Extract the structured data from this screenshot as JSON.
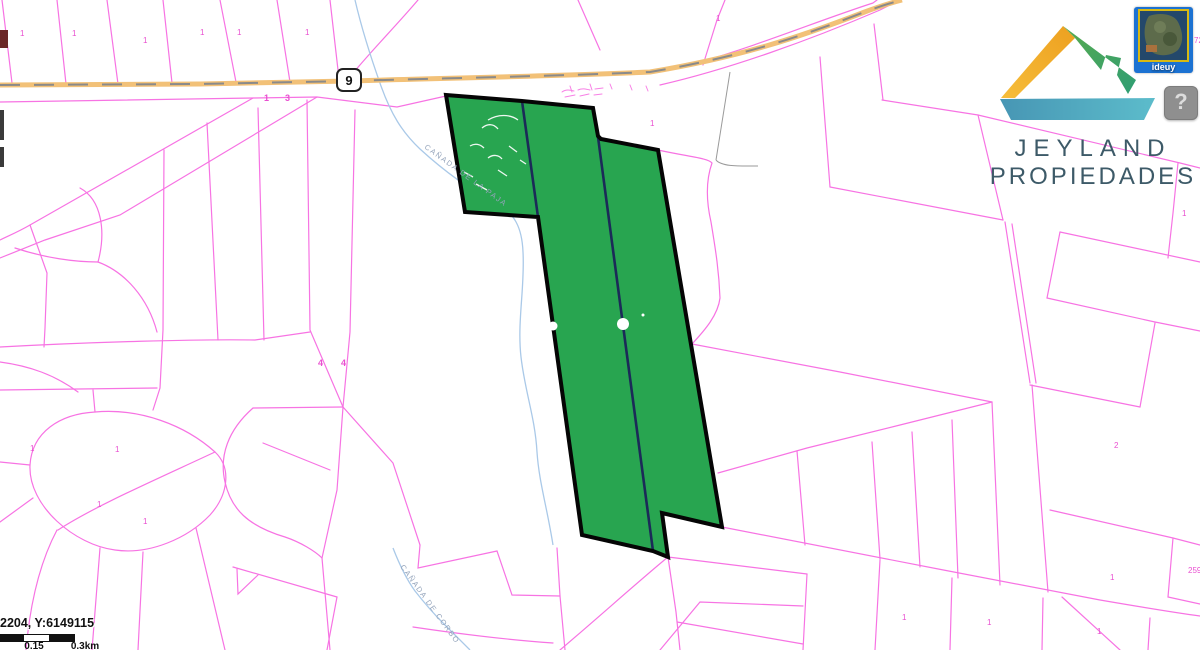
{
  "map": {
    "route_shield_label": "9",
    "stream_labels": [
      {
        "text": "CAÑADA DE LA PAJA",
        "x": 424,
        "y": 148,
        "angle": 36
      },
      {
        "text": "CAÑADA DE CORBO",
        "x": 400,
        "y": 567,
        "angle": 54
      }
    ],
    "parcel_labels": [
      {
        "text": "1",
        "x": 20,
        "y": 36
      },
      {
        "text": "1",
        "x": 72,
        "y": 36
      },
      {
        "text": "1",
        "x": 143,
        "y": 43
      },
      {
        "text": "1",
        "x": 200,
        "y": 35
      },
      {
        "text": "1",
        "x": 237,
        "y": 35
      },
      {
        "text": "1",
        "x": 305,
        "y": 35
      },
      {
        "text": "1",
        "x": 264,
        "y": 101,
        "big": true
      },
      {
        "text": "3",
        "x": 285,
        "y": 101,
        "big": true
      },
      {
        "text": "1",
        "x": 650,
        "y": 126
      },
      {
        "text": "1",
        "x": 716,
        "y": 21
      },
      {
        "text": "4",
        "x": 318,
        "y": 366,
        "big": true
      },
      {
        "text": "4",
        "x": 341,
        "y": 366,
        "big": true
      },
      {
        "text": "1",
        "x": 30,
        "y": 451
      },
      {
        "text": "1",
        "x": 115,
        "y": 452
      },
      {
        "text": "1",
        "x": 97,
        "y": 507
      },
      {
        "text": "1",
        "x": 143,
        "y": 524
      },
      {
        "text": "2",
        "x": 1114,
        "y": 448
      },
      {
        "text": "1",
        "x": 1182,
        "y": 216
      },
      {
        "text": "1",
        "x": 902,
        "y": 620
      },
      {
        "text": "1",
        "x": 987,
        "y": 625
      },
      {
        "text": "1",
        "x": 1097,
        "y": 634
      },
      {
        "text": "1",
        "x": 1110,
        "y": 580
      },
      {
        "text": "259",
        "x": 1188,
        "y": 573
      },
      {
        "text": "72",
        "x": 1194,
        "y": 43
      }
    ]
  },
  "branding": {
    "line1": "JEYLAND",
    "line2": "PROPIEDADES"
  },
  "minimap": {
    "label": "ideuy"
  },
  "help": {
    "label": "?"
  },
  "status": {
    "coordinates": "2204, Y:6149115"
  },
  "scalebar": {
    "mid_label": "0.15",
    "end_label": "0.3km"
  },
  "colors": {
    "parcel_line": "#f773e3",
    "parcel_label": "#e94fd0",
    "highlight_fill": "#28a550",
    "highlight_divider": "#1b2a58",
    "highlight_border": "#050505",
    "road_fill": "#f2c178",
    "road_dash": "#8a8a8a",
    "stream": "#aac9e8",
    "stream_label": "#93a3ba",
    "logo_text": "#3d5a68",
    "minimap_bg": "#1c72d2",
    "minimap_border": "#d8b912"
  }
}
